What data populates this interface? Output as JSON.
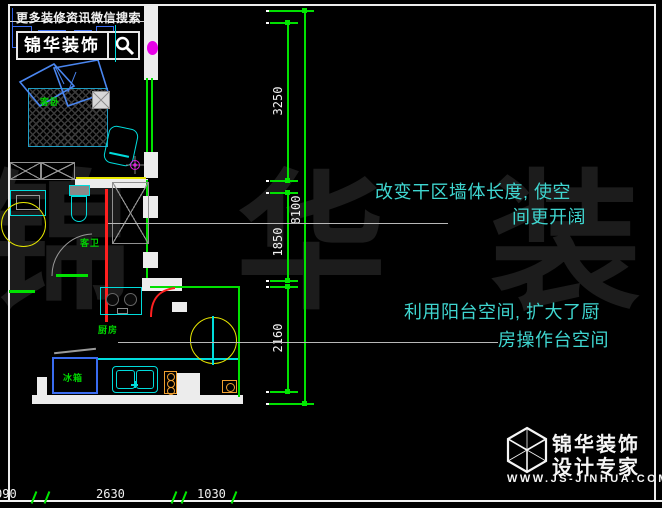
{
  "banner": {
    "promo_text": "更多装修资讯微信搜索",
    "search_label": "锦华装饰",
    "search_icon": "magnifier-icon"
  },
  "plan": {
    "rooms": [
      {
        "label": "客卧"
      },
      {
        "label": "客卫"
      },
      {
        "label": "厨房"
      }
    ],
    "fridge_label": "冰箱"
  },
  "annotations": [
    {
      "line1": "改变干区墙体长度, 使空",
      "line2": "间更开阔"
    },
    {
      "line1": "利用阳台空间, 扩大了厨",
      "line2": "房操作台空间"
    }
  ],
  "dimensions": {
    "vertical": [
      {
        "label": "3250"
      },
      {
        "label": "8100"
      },
      {
        "label": "1850"
      },
      {
        "label": "2160"
      }
    ],
    "horizontal": [
      {
        "label": "090"
      },
      {
        "label": "2630"
      },
      {
        "label": "1030"
      }
    ]
  },
  "watermark": {
    "text": "锦 华 装 饰"
  },
  "logo": {
    "icon": "cube-logo-icon",
    "title": "锦华装饰",
    "subtitle": "设计专家",
    "url": "WWW.JS-JINHUA.COM"
  },
  "colors": {
    "cad_cyan": "#00dcdc",
    "cad_green": "#00e100",
    "dim_green": "#00e800",
    "annotation_cyan": "#3fd6d0",
    "highlight_red": "#ff1f1f",
    "accent_yellow": "#e8e800",
    "furniture_blue": "#3a6cf0",
    "magenta": "#e800e8"
  }
}
